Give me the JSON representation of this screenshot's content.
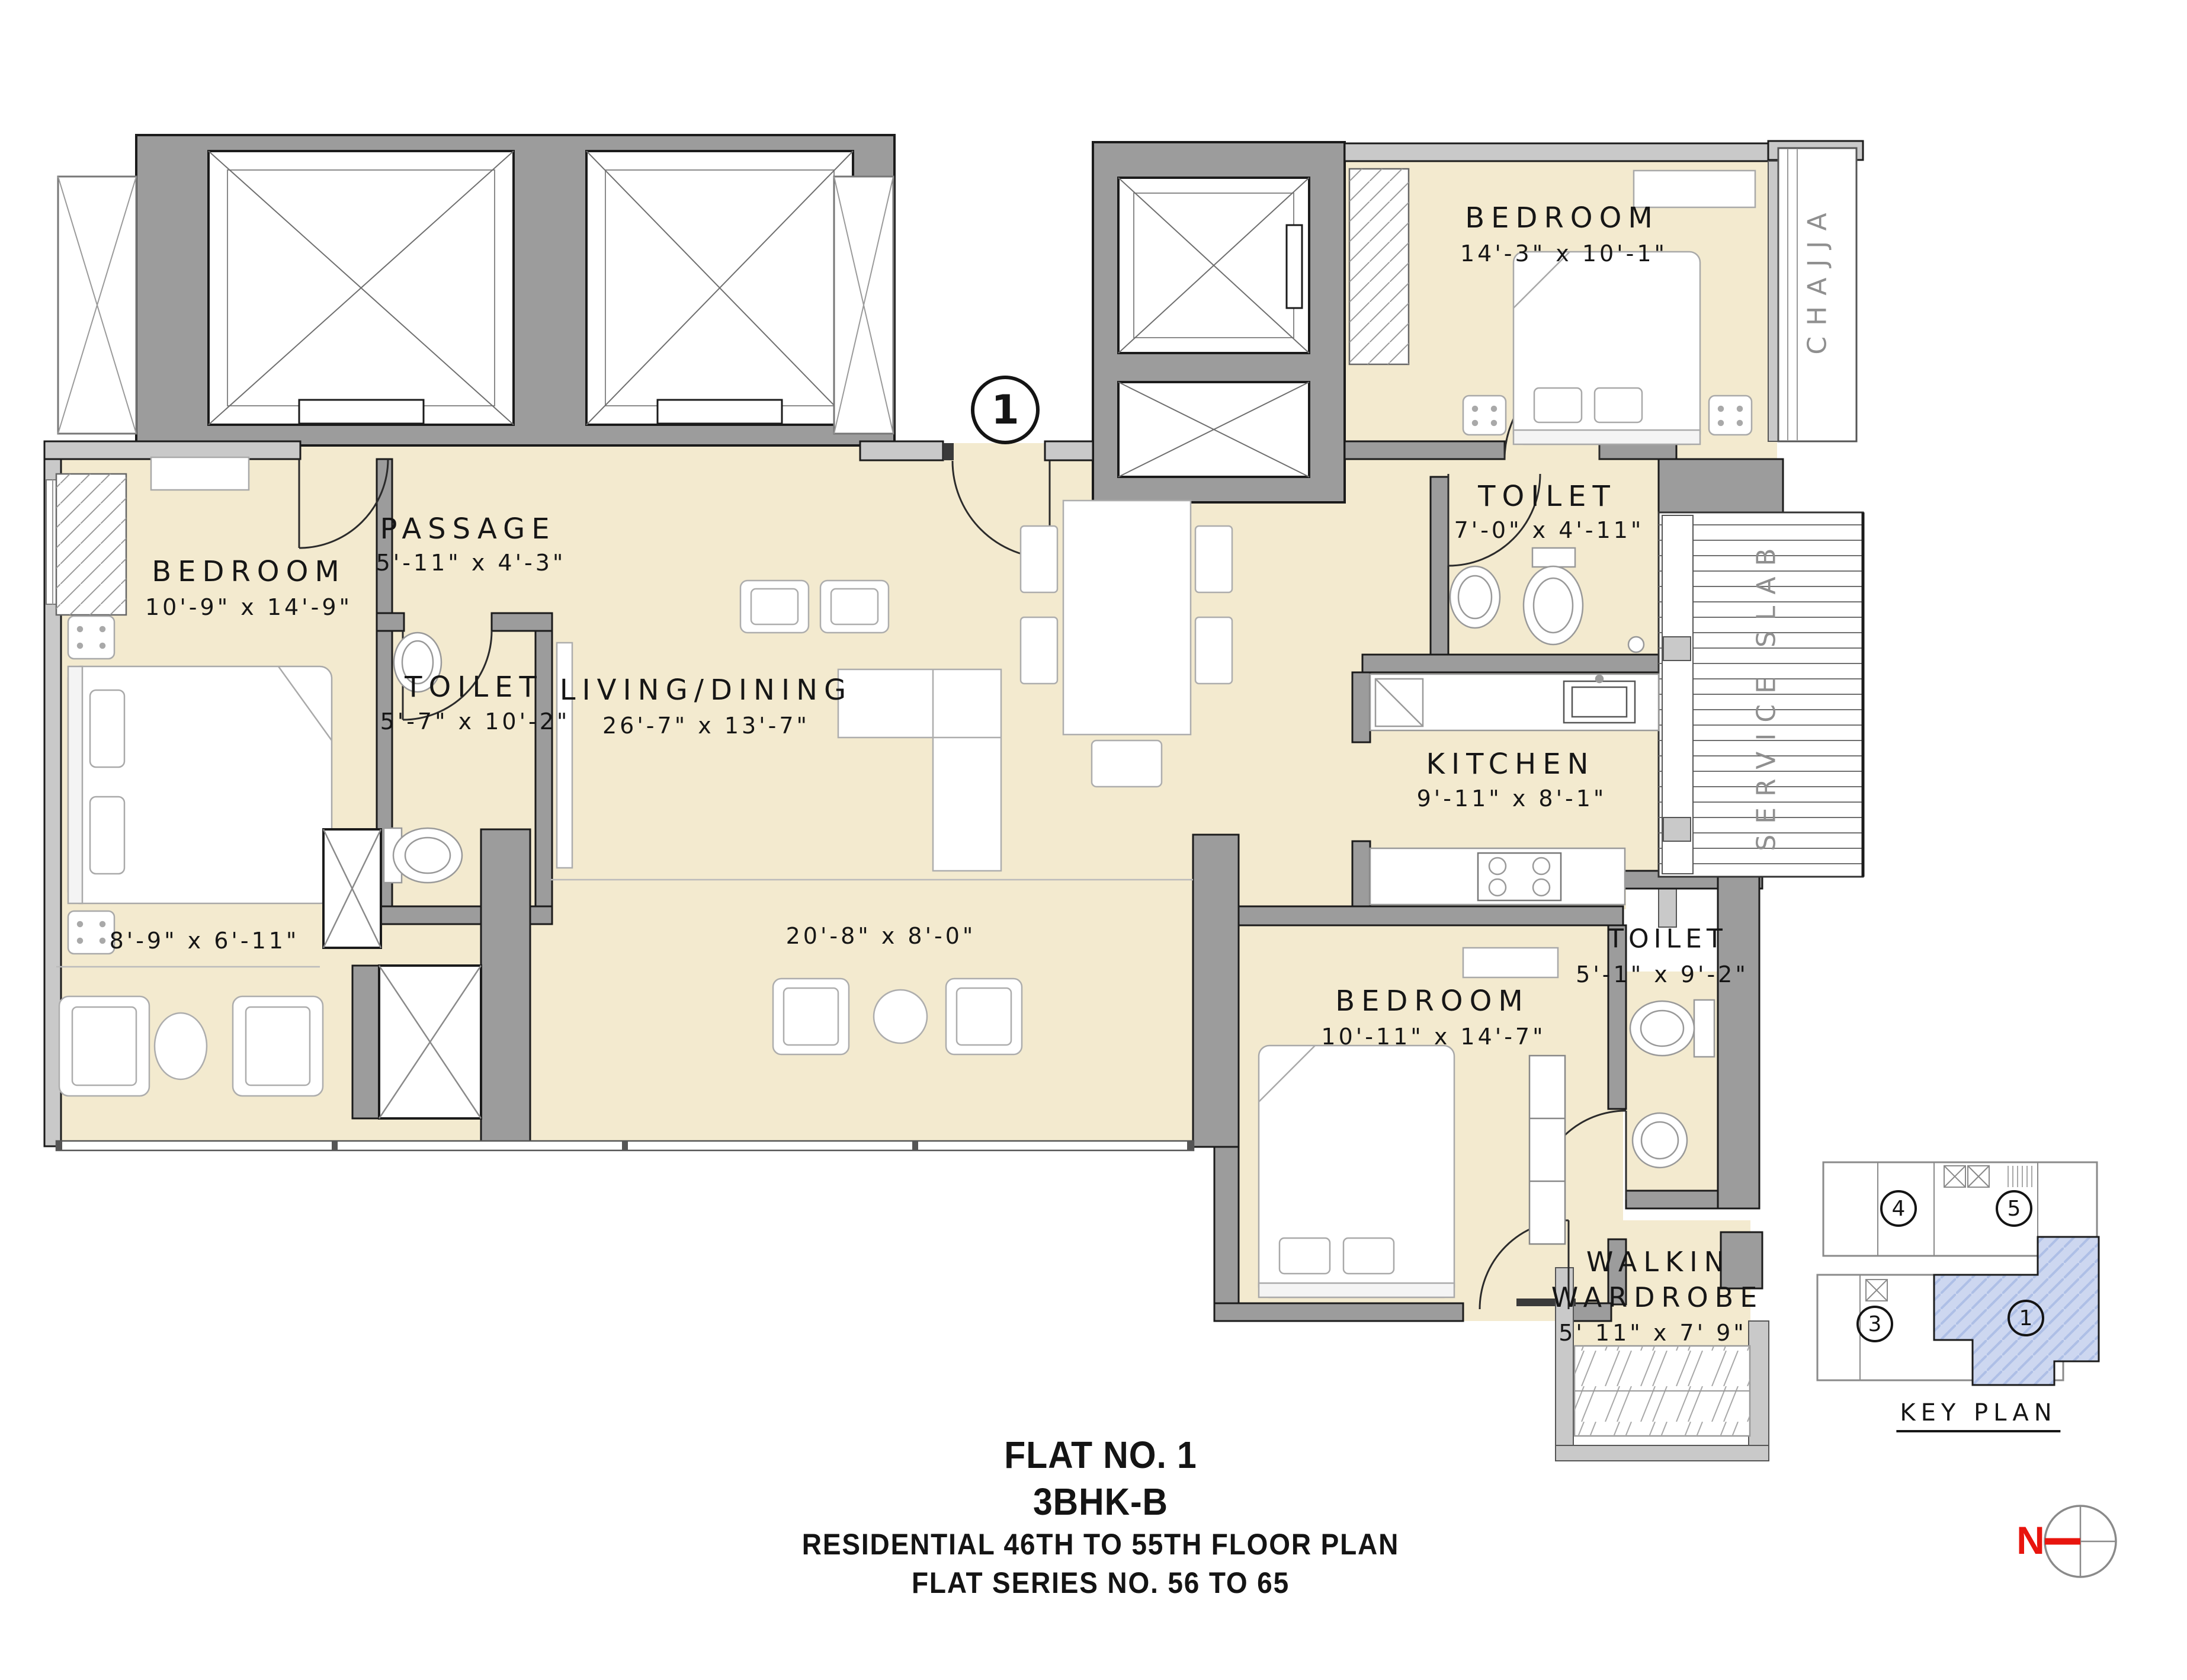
{
  "meta": {
    "flat_marker": "1"
  },
  "rooms": {
    "bedroom_top_right": {
      "name": "BEDROOM",
      "dims": "14'-3\" x 10'-1\""
    },
    "toilet_top_right": {
      "name": "TOILET",
      "dims": "7'-0\" x 4'-11\""
    },
    "passage": {
      "name": "PASSAGE",
      "dims": "5'-11\" x 4'-3\""
    },
    "bedroom_left": {
      "name": "BEDROOM",
      "dims": "10'-9\" x 14'-9\""
    },
    "toilet_left": {
      "name": "TOILET",
      "dims": "5'-7\" x 10'-2\""
    },
    "living_dining": {
      "name": "LIVING/DINING",
      "dims": "26'-7\" x 13'-7\""
    },
    "kitchen": {
      "name": "KITCHEN",
      "dims": "9'-11\" x 8'-1\""
    },
    "bedroom_bottom": {
      "name": "BEDROOM",
      "dims": "10'-11\" x 14'-7\""
    },
    "toilet_bottom": {
      "name": "TOILET",
      "dims": "5'-1\" x 9'-2\""
    },
    "walkin_wardrobe": {
      "name_line1": "WALKIN",
      "name_line2": "WARDROBE",
      "dims": "5' 11\" x 7' 9\""
    }
  },
  "decks": {
    "left_dims": "8'-9\" x 6'-11\"",
    "center_dims": "20'-8\" x 8'-0\""
  },
  "annotations": {
    "chajja": "CHAJJA",
    "service_slab": "SERVICE SLAB"
  },
  "key_plan": {
    "title": "KEY PLAN",
    "unit_4": "4",
    "unit_5": "5",
    "unit_3": "3",
    "unit_1": "1"
  },
  "title_block": {
    "flat_no": "FLAT NO. 1",
    "flat_type": "3BHK-B",
    "subtitle1": "RESIDENTIAL  46TH  TO  55TH  FLOOR  PLAN",
    "subtitle2": "FLAT SERIES NO. 56  TO  65"
  },
  "compass": {
    "north_label": "N"
  },
  "colors": {
    "room_fill": "#f3eacf",
    "wall": "#9c9c9c",
    "wall_light": "#c9c9c9",
    "outline": "#1b1b1b",
    "text": "#141414",
    "muted_text": "#8f8f8f",
    "keyplan_highlight": "#cdd7f0",
    "north_red": "#e8150e"
  }
}
